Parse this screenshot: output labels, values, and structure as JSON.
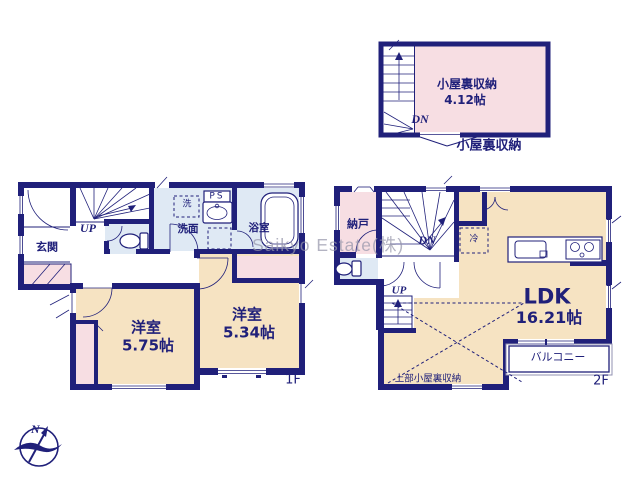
{
  "colors": {
    "wall_navy": "#20207a",
    "room_pink": "#f7dee3",
    "room_cream": "#f6e3c2",
    "room_blue": "#dfe9f4",
    "watermark_gray": "#9696aa"
  },
  "watermark": {
    "text": "Saikyo Estate(株)"
  },
  "compass": {
    "north": "N"
  },
  "attic": {
    "room_name": "小屋裏収納",
    "room_size": "4.12帖",
    "stair_down": "DN",
    "callout": "小屋裏収納"
  },
  "f1": {
    "floor_label": "1F",
    "entrance": "玄関",
    "stair_up": "UP",
    "washer": "洗",
    "pipe_space": "PS",
    "washroom": "洗面",
    "bathroom": "浴室",
    "bedroom1_name": "洋室",
    "bedroom1_size": "5.75帖",
    "bedroom2_name": "洋室",
    "bedroom2_size": "5.34帖"
  },
  "f2": {
    "floor_label": "2F",
    "storage": "納戸",
    "stair_down": "DN",
    "stair_up": "UP",
    "fridge": "冷",
    "ldk_name": "LDK",
    "ldk_size": "16.21帖",
    "balcony": "バルコニー",
    "attic_above_note": "上部小屋裏収納"
  }
}
